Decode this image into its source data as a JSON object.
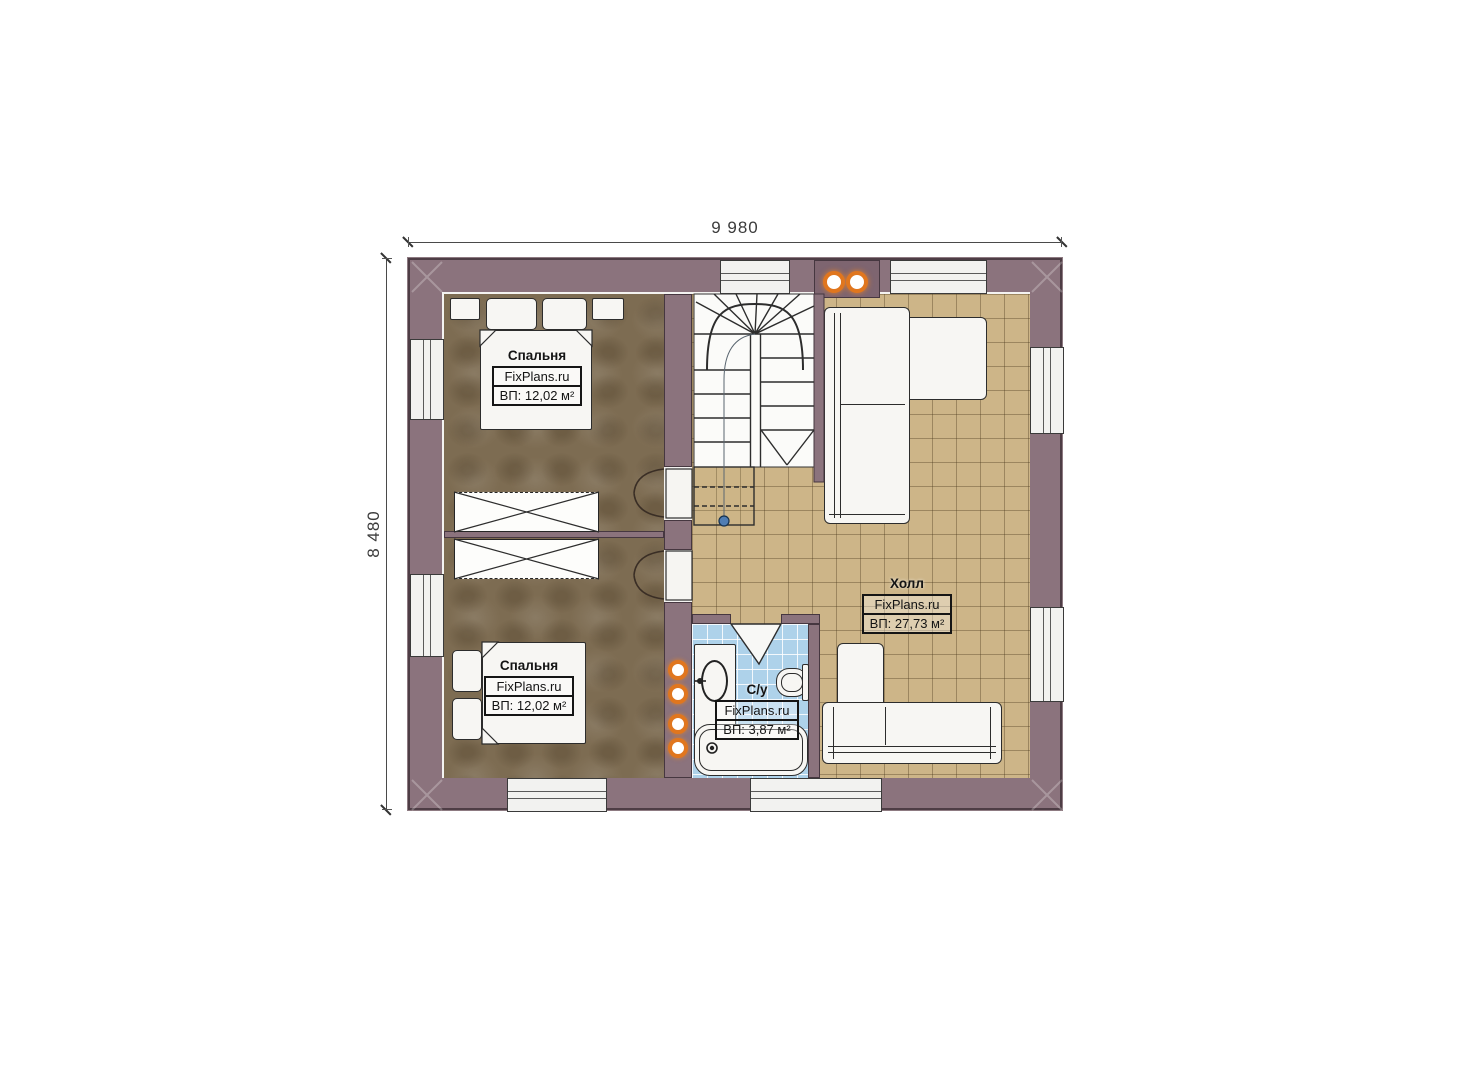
{
  "title": "floor-plan-second-level",
  "dimensions": {
    "width_label": "9 980",
    "height_label": "8 480"
  },
  "rooms": {
    "bedroom1": {
      "name": "Спальня",
      "brand": "FixPlans.ru",
      "area": "ВП: 12,02 м²"
    },
    "bedroom2": {
      "name": "Спальня",
      "brand": "FixPlans.ru",
      "area": "ВП: 12,02 м²"
    },
    "hall": {
      "name": "Холл",
      "brand": "FixPlans.ru",
      "area": "ВП: 27,73 м²"
    },
    "bathroom": {
      "name": "С/у",
      "brand": "FixPlans.ru",
      "area": "ВП: 3,87 м²"
    }
  },
  "icons": {
    "chimney-flue": "orange ring circle",
    "pipe-riser": "orange ring circle",
    "stair-start-marker": "blue dot"
  },
  "colors": {
    "wall": "#8b737d",
    "floor-bed": "#7d6c52",
    "floor-hall": "#cdb588",
    "floor-bath": "#aed2ea",
    "orange": "#e0761e",
    "blue": "#4f7db3"
  }
}
